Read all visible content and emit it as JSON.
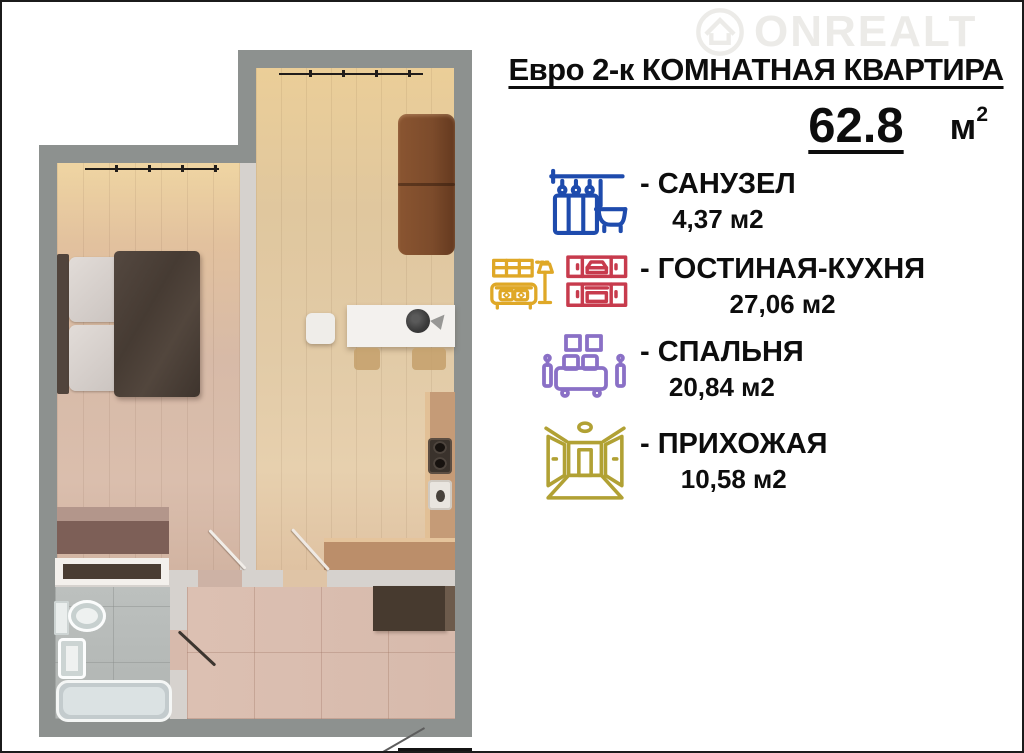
{
  "watermark": {
    "text": "ONREALT",
    "icon": "house-logo"
  },
  "header": {
    "title": "Евро 2-к КОМНАТНАЯ КВАРТИРА",
    "total_area_value": "62.8",
    "total_area_unit": "м",
    "total_area_unit_sup": "2"
  },
  "legend": {
    "items": [
      {
        "name": "bathroom",
        "label": "- САНУЗЕЛ",
        "area": "4,37 м2",
        "icon": "shower-bath-icon",
        "color": "#1e4bad"
      },
      {
        "name": "living-kitchen",
        "label": "- ГОСТИНАЯ-КУХНЯ",
        "area": "27,06 м2",
        "icon": "sofa-kitchen-icon",
        "color": "#dfa827",
        "color2": "#c73b4d"
      },
      {
        "name": "bedroom",
        "label": "- СПАЛЬНЯ",
        "area": "20,84 м2",
        "icon": "bed-icon",
        "color": "#8a70c6"
      },
      {
        "name": "hallway",
        "label": "- ПРИХОЖАЯ",
        "area": "10,58 м2",
        "icon": "hallway-icon",
        "color": "#b1a134"
      }
    ]
  },
  "floorplan": {
    "rooms": [
      "bedroom",
      "living-kitchen",
      "bathroom",
      "hallway"
    ],
    "colors": {
      "wall-outer": "#8d918f",
      "wall-inner": "#d6d2ce",
      "floor-bedroom": "#d7baa7",
      "floor-living": "#e2cba7",
      "floor-hallway": "#d7baac",
      "floor-bathroom": "#b5b9b7",
      "sofa-brown": "#7c4b2b",
      "counter-wood": "#c59b77",
      "dark-furniture": "#473a2f"
    }
  }
}
